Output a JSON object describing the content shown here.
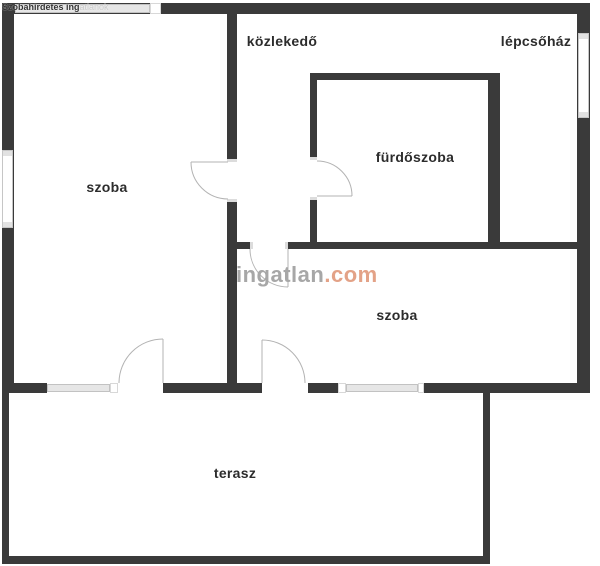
{
  "plan": {
    "watermark_top_left": {
      "primary": "Szobahirdetes ing",
      "secondary": "atlanok"
    },
    "watermark_center": {
      "brand": "ingatlan",
      "suffix": ".com"
    },
    "rooms": [
      {
        "id": "hallway",
        "label": "közlekedő"
      },
      {
        "id": "staircase",
        "label": "lépcsőház"
      },
      {
        "id": "bathroom",
        "label": "fürdőszoba"
      },
      {
        "id": "room-left",
        "label": "szoba"
      },
      {
        "id": "room-right",
        "label": "szoba"
      },
      {
        "id": "terrace",
        "label": "terasz"
      }
    ],
    "colors": {
      "wall": "#3a3a3a",
      "window_fill": "#e6e6e6",
      "window_border": "#c2c2c2",
      "door_line": "#b3b3b3",
      "label_text": "#2c2c2c",
      "watermark_gray": "#a7a7a7",
      "watermark_orange": "#e3a287"
    }
  }
}
